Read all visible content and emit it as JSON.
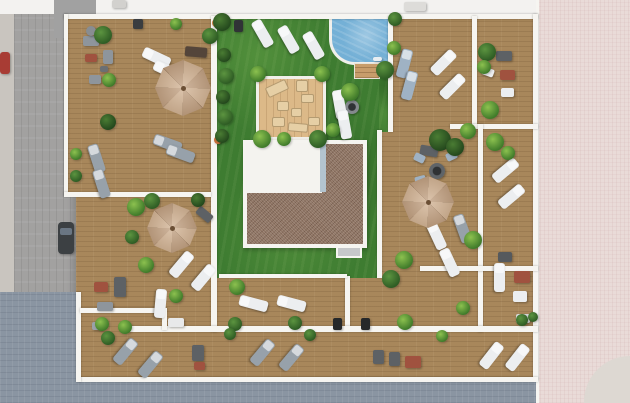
{
  "scene": {
    "title": "rooftop-terraces-aerial-render",
    "canvas": {
      "w": 630,
      "h": 403
    },
    "palette": {
      "wood": "#a8875b",
      "woodLight": "#dcb988",
      "lawn": "#3e7c31",
      "pool": "#74b0d6",
      "wall": "#f6f5f1",
      "gravel": "#8d7261",
      "whiteRoof": "#f4f3ef",
      "streetGray": "#a2a1a0",
      "streetBlue": "#8a95a2",
      "pavementPink": "#e9dbd8",
      "umbrellaTan": "#cfae8d",
      "loungerWhite": "#eceef0",
      "loungerGray": "#97a1aa",
      "loungerBlue": "#9fb2c4",
      "sofaDark": "#5d6165",
      "sofaGray": "#8e959c",
      "tableRed": "#a0523f",
      "plantGreen": "#3e7d2f"
    },
    "surfaces": [
      {
        "n": "street-left",
        "cls": "street-gray",
        "x": 0,
        "y": 0,
        "w": 76,
        "h": 403
      },
      {
        "n": "sidewalk-left",
        "cls": "sidewalk",
        "x": 0,
        "y": 0,
        "w": 14,
        "h": 403
      },
      {
        "n": "street-top-band",
        "cls": "plain",
        "x": 0,
        "y": 0,
        "w": 630,
        "h": 14,
        "c": "#f3f2f0"
      },
      {
        "n": "neighbor-block-top-left",
        "cls": "plain",
        "x": 54,
        "y": 0,
        "w": 42,
        "h": 38,
        "c": "#a1a1a1"
      },
      {
        "n": "street-bottom",
        "cls": "street-blue",
        "x": 0,
        "y": 379,
        "w": 630,
        "h": 24
      },
      {
        "n": "street-corner-bottom-left",
        "cls": "street-blue",
        "x": 0,
        "y": 292,
        "w": 76,
        "h": 111
      },
      {
        "n": "pavement-right",
        "cls": "pavement-pink",
        "x": 536,
        "y": 0,
        "w": 94,
        "h": 403
      },
      {
        "n": "pavement-corner-light",
        "cls": "plain",
        "x": 584,
        "y": 356,
        "w": 46,
        "h": 47,
        "c": "#ddd8d2",
        "r": "70px 0 0 0"
      },
      {
        "n": "deck-main",
        "cls": "deck-wood",
        "x": 76,
        "y": 14,
        "w": 462,
        "h": 368
      },
      {
        "n": "deck-top-left-terrace",
        "cls": "deck-wood",
        "x": 64,
        "y": 14,
        "w": 150,
        "h": 180
      },
      {
        "n": "lawn-main",
        "cls": "lawn",
        "x": 217,
        "y": 16,
        "w": 162,
        "h": 262
      },
      {
        "n": "lawn-pool-strip",
        "cls": "lawn",
        "x": 379,
        "y": 16,
        "w": 14,
        "h": 116
      },
      {
        "n": "pool",
        "cls": "pool",
        "x": 329,
        "y": 15,
        "w": 63,
        "h": 50
      },
      {
        "n": "pool-steps",
        "cls": "steps",
        "x": 354,
        "y": 63,
        "w": 26,
        "h": 16
      },
      {
        "n": "timber-platform",
        "cls": "deck-light",
        "x": 256,
        "y": 76,
        "w": 70,
        "h": 64
      },
      {
        "n": "roof-core-gravel",
        "cls": "gravel",
        "x": 243,
        "y": 140,
        "w": 124,
        "h": 108
      },
      {
        "n": "roof-core-white",
        "cls": "plain",
        "x": 246,
        "y": 143,
        "w": 76,
        "h": 50,
        "c": "#f4f3ef"
      },
      {
        "n": "roof-core-skylight",
        "cls": "plain",
        "x": 320,
        "y": 144,
        "w": 6,
        "h": 48,
        "c": "#b3c4cf"
      },
      {
        "n": "roof-vent-box",
        "cls": "plain",
        "x": 336,
        "y": 246,
        "w": 26,
        "h": 12,
        "c": "#c6c8ca",
        "b": "2px solid #f6f5f1"
      }
    ],
    "walls": [
      [
        64,
        14,
        474,
        5
      ],
      [
        533,
        14,
        5,
        366
      ],
      [
        78,
        377,
        460,
        5
      ],
      [
        76,
        292,
        5,
        90
      ],
      [
        64,
        14,
        4,
        182
      ],
      [
        211,
        16,
        6,
        316
      ],
      [
        64,
        192,
        147,
        5
      ],
      [
        377,
        130,
        5,
        148
      ],
      [
        388,
        16,
        5,
        116
      ],
      [
        472,
        16,
        5,
        110
      ],
      [
        450,
        124,
        88,
        5
      ],
      [
        478,
        124,
        5,
        208
      ],
      [
        345,
        276,
        5,
        54
      ],
      [
        219,
        274,
        128,
        4
      ],
      [
        130,
        326,
        408,
        6
      ],
      [
        80,
        308,
        86,
        5
      ],
      [
        162,
        308,
        5,
        22
      ],
      [
        420,
        266,
        118,
        5
      ]
    ],
    "furniture": [
      {
        "n": "sofa-top-left-a",
        "x": 83,
        "y": 36,
        "w": 16,
        "h": 10,
        "rot": 0,
        "c": "#8e959c"
      },
      {
        "n": "sofa-top-left-b",
        "x": 103,
        "y": 50,
        "w": 10,
        "h": 14,
        "rot": 0,
        "c": "#8e959c"
      },
      {
        "n": "ottoman-red-top-left",
        "x": 85,
        "y": 54,
        "w": 12,
        "h": 8,
        "rot": 0,
        "c": "#a0523f"
      },
      {
        "n": "chair-top-left",
        "x": 89,
        "y": 75,
        "w": 12,
        "h": 9,
        "rot": 0,
        "c": "#8e959c"
      },
      {
        "n": "coffee-table-top-left",
        "x": 100,
        "y": 66,
        "w": 8,
        "h": 6,
        "rot": 0,
        "c": "#6b6f73"
      },
      {
        "n": "picnic-table",
        "x": 185,
        "y": 47,
        "w": 22,
        "h": 10,
        "rot": 5,
        "c": "#54453a"
      },
      {
        "n": "bench-mid-left",
        "x": 196,
        "y": 210,
        "w": 17,
        "h": 9,
        "rot": 40,
        "c": "#5d6165"
      },
      {
        "n": "sofa-top-right",
        "x": 496,
        "y": 51,
        "w": 16,
        "h": 10,
        "rot": 0,
        "c": "#5d6165"
      },
      {
        "n": "table-red-top-right",
        "x": 500,
        "y": 70,
        "w": 15,
        "h": 10,
        "rot": 0,
        "c": "#a0523f"
      },
      {
        "n": "chair-white-top-right-a",
        "x": 482,
        "y": 68,
        "w": 12,
        "h": 8,
        "rot": 20,
        "c": "#eceef0"
      },
      {
        "n": "chair-white-top-right-b",
        "x": 501,
        "y": 88,
        "w": 13,
        "h": 9,
        "rot": 0,
        "c": "#eceef0"
      },
      {
        "n": "sofa-dark-se-terrace",
        "x": 420,
        "y": 146,
        "w": 18,
        "h": 10,
        "rot": 10,
        "c": "#5d6165"
      },
      {
        "n": "table-red-bottom-left",
        "x": 94,
        "y": 282,
        "w": 14,
        "h": 10,
        "rot": 0,
        "c": "#a0523f"
      },
      {
        "n": "sofa-bottom-left",
        "x": 114,
        "y": 277,
        "w": 12,
        "h": 20,
        "rot": 0,
        "c": "#5d6165"
      },
      {
        "n": "bench-bottom-left",
        "x": 97,
        "y": 302,
        "w": 16,
        "h": 9,
        "rot": 0,
        "c": "#8e959c"
      },
      {
        "n": "chair-bottom-left",
        "x": 92,
        "y": 322,
        "w": 11,
        "h": 8,
        "rot": 0,
        "c": "#9aa1a8"
      },
      {
        "n": "bench-balcony-a",
        "x": 192,
        "y": 345,
        "w": 12,
        "h": 16,
        "rot": 0,
        "c": "#5d6165"
      },
      {
        "n": "table-red-balcony-a",
        "x": 194,
        "y": 362,
        "w": 11,
        "h": 8,
        "rot": 0,
        "c": "#a0523f"
      },
      {
        "n": "bench-balcony-b",
        "x": 373,
        "y": 350,
        "w": 11,
        "h": 14,
        "rot": 0,
        "c": "#5d6165"
      },
      {
        "n": "bench-balcony-c",
        "x": 389,
        "y": 352,
        "w": 11,
        "h": 14,
        "rot": 0,
        "c": "#5d6165"
      },
      {
        "n": "table-red-balcony-b",
        "x": 405,
        "y": 356,
        "w": 16,
        "h": 12,
        "rot": 0,
        "c": "#a0523f"
      },
      {
        "n": "table-red-bottom-right",
        "x": 514,
        "y": 271,
        "w": 16,
        "h": 12,
        "rot": 0,
        "c": "#a0523f"
      },
      {
        "n": "pouf-bottom-right",
        "x": 513,
        "y": 291,
        "w": 14,
        "h": 11,
        "rot": 0,
        "c": "#eceef0"
      },
      {
        "n": "bbq-grill-a",
        "x": 333,
        "y": 318,
        "w": 9,
        "h": 12,
        "rot": 0,
        "c": "#26282a"
      },
      {
        "n": "bbq-grill-b",
        "x": 361,
        "y": 318,
        "w": 9,
        "h": 12,
        "rot": 0,
        "c": "#26282a"
      },
      {
        "n": "grill-table-right",
        "x": 498,
        "y": 252,
        "w": 14,
        "h": 10,
        "rot": 0,
        "c": "#55595d"
      },
      {
        "n": "chair-blue-a",
        "x": 414,
        "y": 154,
        "w": 11,
        "h": 8,
        "rot": 25,
        "c": "#9fb2c4"
      },
      {
        "n": "chair-blue-b",
        "x": 446,
        "y": 152,
        "w": 11,
        "h": 8,
        "rot": -25,
        "c": "#9fb2c4"
      },
      {
        "n": "chair-blue-c",
        "x": 415,
        "y": 176,
        "w": 11,
        "h": 8,
        "rot": -15,
        "c": "#9fb2c4"
      },
      {
        "n": "chair-white-lawn-a",
        "x": 336,
        "y": 90,
        "w": 10,
        "h": 8,
        "rot": -30,
        "c": "#eceef0"
      },
      {
        "n": "chair-white-lawn-b",
        "x": 338,
        "y": 114,
        "w": 10,
        "h": 8,
        "rot": 30,
        "c": "#eceef0"
      },
      {
        "n": "rooftop-box-a",
        "x": 112,
        "y": 0,
        "w": 14,
        "h": 8,
        "rot": 0,
        "c": "#d2d1ce"
      },
      {
        "n": "rooftop-box-b",
        "x": 404,
        "y": 2,
        "w": 22,
        "h": 9,
        "rot": 0,
        "c": "#dddcd9"
      },
      {
        "n": "wall-unit-dark-a",
        "x": 133,
        "y": 19,
        "w": 10,
        "h": 10,
        "rot": 0,
        "c": "#3a3d40"
      },
      {
        "n": "wall-unit-dark-b",
        "x": 234,
        "y": 20,
        "w": 9,
        "h": 12,
        "rot": 0,
        "c": "#303336"
      },
      {
        "n": "wall-table-white-a",
        "x": 168,
        "y": 318,
        "w": 16,
        "h": 9,
        "rot": 0,
        "c": "#e8e9ea"
      },
      {
        "n": "wall-table-white-b",
        "x": 516,
        "y": 314,
        "w": 14,
        "h": 9,
        "rot": 0,
        "c": "#d7d9da"
      },
      {
        "n": "pool-ladder",
        "x": 373,
        "y": 57,
        "w": 9,
        "h": 4,
        "rot": 0,
        "c": "#e8eef2"
      },
      {
        "n": "car-dark",
        "x": 58,
        "y": 222,
        "w": 16,
        "h": 32,
        "rot": 0,
        "c": "#3c4043",
        "rd": "4px"
      },
      {
        "n": "car-red",
        "x": 0,
        "y": 52,
        "w": 10,
        "h": 22,
        "rot": 0,
        "c": "#a83c34",
        "rd": "3px"
      },
      {
        "n": "cushion-1",
        "cls": "cushion",
        "x": 266,
        "y": 83,
        "w": 22,
        "h": 11,
        "rot": -25,
        "c": "#e6cfa5"
      },
      {
        "n": "cushion-2",
        "cls": "cushion",
        "x": 296,
        "y": 80,
        "w": 12,
        "h": 12,
        "rot": 0,
        "c": "#e6cfa5"
      },
      {
        "n": "cushion-3",
        "cls": "cushion",
        "x": 301,
        "y": 94,
        "w": 13,
        "h": 9,
        "rot": 0,
        "c": "#e6cfa5"
      },
      {
        "n": "cushion-4",
        "cls": "cushion",
        "x": 277,
        "y": 101,
        "w": 12,
        "h": 10,
        "rot": 0,
        "c": "#e6cfa5"
      },
      {
        "n": "cushion-5",
        "cls": "cushion",
        "x": 291,
        "y": 108,
        "w": 11,
        "h": 9,
        "rot": 0,
        "c": "#e6cfa5"
      },
      {
        "n": "cushion-6",
        "cls": "cushion",
        "x": 272,
        "y": 117,
        "w": 13,
        "h": 10,
        "rot": 0,
        "c": "#e6cfa5"
      },
      {
        "n": "cushion-7",
        "cls": "cushion",
        "x": 288,
        "y": 123,
        "w": 20,
        "h": 9,
        "rot": 5,
        "c": "#e6cfa5"
      },
      {
        "n": "cushion-8",
        "cls": "cushion",
        "x": 308,
        "y": 117,
        "w": 12,
        "h": 9,
        "rot": 0,
        "c": "#e6cfa5"
      }
    ],
    "circles": [
      {
        "n": "fire-table-lawn",
        "x": 352,
        "y": 107,
        "r": 7,
        "c": "#84898d",
        "inner": true
      },
      {
        "n": "fire-table-se",
        "x": 437,
        "y": 171,
        "r": 8,
        "c": "#5f6468",
        "inner": true
      },
      {
        "n": "trash-bin",
        "x": 91,
        "y": 31,
        "r": 5,
        "c": "#888d92"
      },
      {
        "n": "flower-pot-a",
        "x": 216,
        "y": 23,
        "r": 4,
        "c": "#cf7f43"
      },
      {
        "n": "flower-pot-b",
        "x": 218,
        "y": 140,
        "r": 4,
        "c": "#c9703a"
      }
    ],
    "loungers": [
      [
        262,
        33,
        60,
        "w"
      ],
      [
        288,
        39,
        60,
        "w"
      ],
      [
        313,
        45,
        60,
        "w"
      ],
      [
        339,
        104,
        80,
        "w"
      ],
      [
        344,
        124,
        80,
        "w"
      ],
      [
        156,
        57,
        25,
        "w"
      ],
      [
        167,
        70,
        25,
        "w"
      ],
      [
        96,
        158,
        72,
        "g"
      ],
      [
        101,
        183,
        72,
        "g"
      ],
      [
        167,
        143,
        20,
        "g"
      ],
      [
        180,
        153,
        20,
        "g"
      ],
      [
        404,
        63,
        105,
        "b"
      ],
      [
        409,
        85,
        105,
        "b"
      ],
      [
        443,
        62,
        135,
        "w"
      ],
      [
        452,
        86,
        135,
        "w"
      ],
      [
        505,
        170,
        140,
        "w"
      ],
      [
        511,
        196,
        140,
        "w"
      ],
      [
        181,
        264,
        130,
        "w"
      ],
      [
        203,
        277,
        130,
        "w"
      ],
      [
        436,
        235,
        65,
        "w"
      ],
      [
        449,
        262,
        65,
        "w"
      ],
      [
        253,
        303,
        15,
        "w"
      ],
      [
        291,
        303,
        15,
        "w"
      ],
      [
        125,
        351,
        130,
        "g"
      ],
      [
        150,
        364,
        130,
        "g"
      ],
      [
        262,
        352,
        130,
        "g"
      ],
      [
        291,
        357,
        130,
        "g"
      ],
      [
        491,
        355,
        128,
        "w"
      ],
      [
        517,
        357,
        128,
        "w"
      ],
      [
        462,
        228,
        70,
        "g"
      ],
      [
        160,
        303,
        95,
        "w"
      ],
      [
        499,
        277,
        90,
        "w"
      ]
    ],
    "plants": [
      [
        103,
        35,
        9,
        1
      ],
      [
        109,
        80,
        7,
        2
      ],
      [
        210,
        36,
        8,
        1
      ],
      [
        224,
        55,
        7,
        0
      ],
      [
        226,
        76,
        8,
        1
      ],
      [
        223,
        97,
        7,
        0
      ],
      [
        225,
        117,
        8,
        1
      ],
      [
        222,
        136,
        7,
        0
      ],
      [
        222,
        22,
        9,
        0
      ],
      [
        258,
        74,
        8,
        2
      ],
      [
        322,
        74,
        8,
        2
      ],
      [
        262,
        139,
        9,
        2
      ],
      [
        318,
        139,
        9,
        1
      ],
      [
        284,
        139,
        7,
        2
      ],
      [
        333,
        130,
        7,
        2
      ],
      [
        350,
        92,
        9,
        2
      ],
      [
        385,
        70,
        9,
        1
      ],
      [
        394,
        48,
        7,
        2
      ],
      [
        395,
        19,
        7,
        1
      ],
      [
        487,
        52,
        9,
        1
      ],
      [
        484,
        67,
        7,
        2
      ],
      [
        490,
        110,
        9,
        2
      ],
      [
        468,
        131,
        8,
        2
      ],
      [
        440,
        140,
        11,
        0
      ],
      [
        455,
        147,
        9,
        0
      ],
      [
        495,
        142,
        9,
        2
      ],
      [
        508,
        153,
        7,
        2
      ],
      [
        404,
        260,
        9,
        2
      ],
      [
        473,
        240,
        9,
        2
      ],
      [
        391,
        279,
        9,
        1
      ],
      [
        405,
        322,
        8,
        2
      ],
      [
        237,
        287,
        8,
        2
      ],
      [
        235,
        324,
        7,
        1
      ],
      [
        295,
        323,
        7,
        1
      ],
      [
        102,
        324,
        7,
        2
      ],
      [
        176,
        296,
        7,
        2
      ],
      [
        136,
        207,
        9,
        2
      ],
      [
        152,
        201,
        8,
        1
      ],
      [
        198,
        200,
        7,
        0
      ],
      [
        132,
        237,
        7,
        1
      ],
      [
        146,
        265,
        8,
        2
      ],
      [
        108,
        122,
        8,
        0
      ],
      [
        76,
        154,
        6,
        2
      ],
      [
        76,
        176,
        6,
        1
      ],
      [
        108,
        338,
        7,
        1
      ],
      [
        125,
        327,
        7,
        2
      ],
      [
        230,
        334,
        6,
        1
      ],
      [
        310,
        335,
        6,
        1
      ],
      [
        442,
        336,
        6,
        2
      ],
      [
        522,
        320,
        6,
        1
      ],
      [
        533,
        317,
        5,
        1
      ],
      [
        176,
        24,
        6,
        2
      ],
      [
        463,
        308,
        7,
        2
      ]
    ],
    "umbrellas": [
      [
        183,
        88,
        28
      ],
      [
        172,
        228,
        25
      ],
      [
        428,
        202,
        26
      ]
    ]
  }
}
